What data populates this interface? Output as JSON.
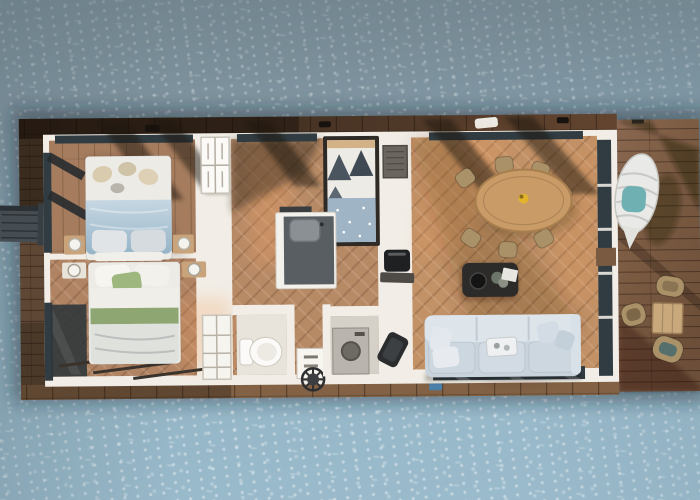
{
  "scene": {
    "description": "Top-down 3D rendered floor plan of a rectangular houseboat floating on open water, with wooden decks on all sides and a large terrace deck on the right",
    "render_type": "aerial floor plan render",
    "text_on_screen": ""
  },
  "colors": {
    "water_top": "#7E939E",
    "water_mid": "#8AA9B9",
    "water_bottom": "#97B8C9",
    "foam": "#EAF1F4",
    "roof_band": "#4A3526",
    "deck_left": "#5E4734",
    "deck_right": "#7A5A41",
    "deck_edge": "#826144",
    "wall": "#F2EEE7",
    "wall_shade": "#D9D3C9",
    "glass": "#313C42",
    "floor_master": "#A57C5E",
    "floor_hall": "#B78A66",
    "floor_living": "#C29166",
    "floor_tile": "#E8E4DC",
    "floor_utility": "#D5D1C9",
    "sun_patch": "#EE9E62",
    "shadow": "#2A1D14",
    "bed_linen": "#EDEBE5",
    "duvet_blue": "#A6C0D2",
    "duvet_gray": "#D5DAD9",
    "green_blanket": "#9DB77F",
    "pillow_beige": "#D8CBAE",
    "sofa": "#C9D3DC",
    "sofa_light": "#DDE4EA",
    "coffee_table": "#2C2B29",
    "dining_table": "#C89B67",
    "wicker": "#AB9168",
    "counter_top": "#595E63",
    "sink": "#8B9094",
    "appliance": "#1F2022",
    "washer": "#B9B5AE",
    "toilet": "#FBFAF8",
    "egg_chair": "#E9E9E7",
    "teal_cushion": "#6FB0B2",
    "outdoor_table": "#C9A87C",
    "nightstand": "#C9A47B",
    "lamp": "#F5F3EE",
    "stool": "#2E2F31",
    "gangplank": "#454D53",
    "fender": "#4A7FA8",
    "centerpiece": "#E2B42C"
  },
  "rooms": [
    "master-bedroom",
    "second-bedroom",
    "bunk-room",
    "hallway",
    "kitchen",
    "bathroom",
    "utility-room",
    "living-dining-area",
    "left-side-deck",
    "right-terrace-deck"
  ],
  "labels": {
    "master_bed": "Double bed with blue duvet",
    "second_bed": "Bed with green striped blanket",
    "bunk_bed": "Single bed with patterned bedding",
    "sofa": "Large light-grey sofa",
    "coffee_table": "Dark coffee table with decor",
    "dining_table": "Round wooden dining table",
    "dining_chair": "Wicker dining chair",
    "kitchen_counter": "L-shaped kitchen counter with sink",
    "oven": "Black oven",
    "art_panel": "Dark wall panel",
    "wardrobe": "White wardrobe",
    "shelf": "White shelving unit",
    "toilet": "Toilet",
    "vanity": "Small cabinet with stool",
    "stool": "Black stool",
    "washer": "Washing machine",
    "armchair": "Dark lounge chair",
    "egg_chair": "Hanging lounge pod with teal towel",
    "terrace_table": "Square terrace table",
    "terrace_chair": "Rattan terrace chair",
    "gangplank": "Boarding ramp",
    "nightstand": "Nightstand with round lamp",
    "vent": "Roof vent",
    "fender": "Blue fender"
  },
  "counts": {
    "bedrooms": 3,
    "dining_chairs": 7,
    "terrace_chairs": 3,
    "sofa_pillows": 4,
    "nightstands": 4
  }
}
